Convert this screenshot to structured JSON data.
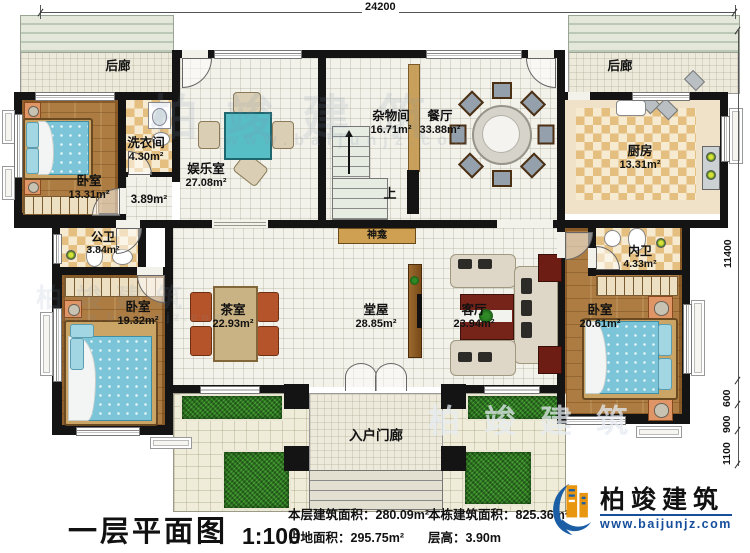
{
  "dimensions": {
    "top": "24200",
    "right_main": "11400",
    "right_b1": "600",
    "right_b2": "900",
    "right_b3": "1100"
  },
  "rooms": {
    "porch_left": {
      "label": "后廊"
    },
    "porch_right": {
      "label": "后廊"
    },
    "bedroom_tl": {
      "label": "卧室",
      "area": "13.31m²"
    },
    "laundry": {
      "label": "洗衣间",
      "area": "4.30m²"
    },
    "hallway": {
      "area": "3.89m²"
    },
    "entertainment": {
      "label": "娱乐室",
      "area": "27.08m²"
    },
    "storage": {
      "label": "杂物间",
      "area": "16.71m²"
    },
    "dining": {
      "label": "餐厅",
      "area": "33.88m²"
    },
    "kitchen": {
      "label": "厨房",
      "area": "13.31m²"
    },
    "public_bath": {
      "label": "公卫",
      "area": "3.84m²"
    },
    "bedroom_bl": {
      "label": "卧室",
      "area": "19.32m²"
    },
    "tea_room": {
      "label": "茶室",
      "area": "22.93m²"
    },
    "main_hall": {
      "label": "堂屋",
      "area": "28.85m²"
    },
    "living": {
      "label": "客厅",
      "area": "23.94m²"
    },
    "bedroom_br": {
      "label": "卧室",
      "area": "20.61m²"
    },
    "ensuite": {
      "label": "内卫",
      "area": "4.33m²"
    },
    "shrine": {
      "label": "神龛"
    },
    "stairs": {
      "label": "上"
    },
    "entry_porch": {
      "label": "入户门廊"
    }
  },
  "footer": {
    "title": "一层平面图",
    "scale": "1:100",
    "stats": {
      "floor_area_label": "本层建筑面积：",
      "floor_area_value": "280.09m²",
      "land_area_label": "占地面积：",
      "land_area_value": "295.75m²",
      "total_area_label": "本栋建筑面积：",
      "total_area_value": "825.36m²",
      "height_label": "层高：",
      "height_value": "3.90m"
    },
    "brand": {
      "name": "柏竣建筑",
      "website": "www.baijunjz.com"
    }
  },
  "watermark": {
    "name": "柏竣建筑",
    "website": "www.baijunjz.com"
  },
  "colors": {
    "brand_blue": "#1b5ea6",
    "brand_orange": "#e8950f",
    "wall": "#141414",
    "grass": "#2d7a21"
  }
}
